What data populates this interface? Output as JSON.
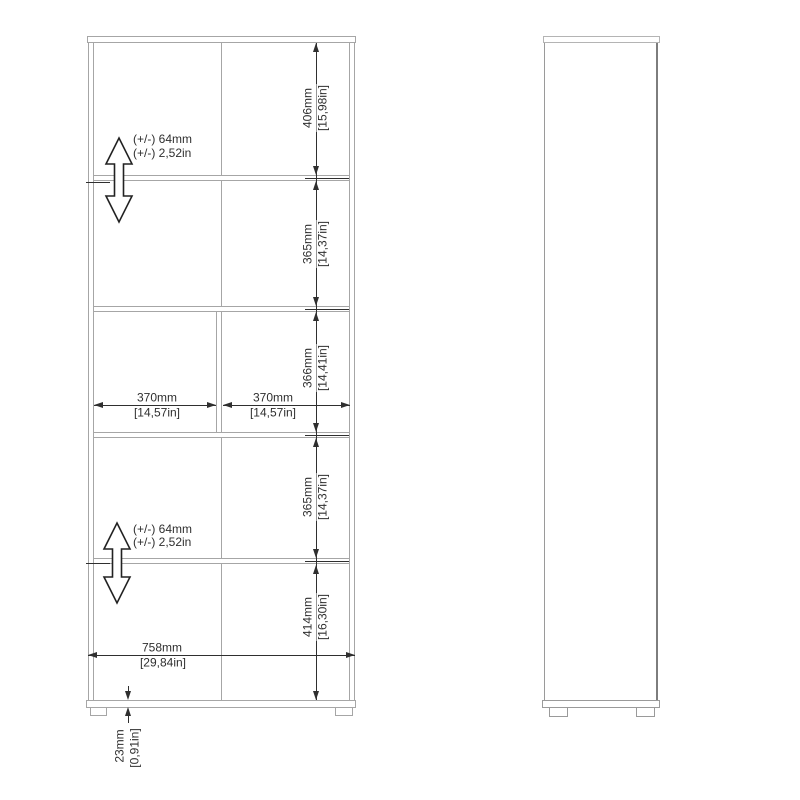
{
  "page": {
    "title": "Bookcase dimension drawing"
  },
  "colors": {
    "outline_gray": "#a6a6a6",
    "side_edge_gray": "#8d8d8d",
    "dimension_dark": "#2f2f2f",
    "background": "#ffffff"
  },
  "front_view": {
    "vertical_dims": [
      {
        "mm": "406mm",
        "in": "[15,98in]"
      },
      {
        "mm": "365mm",
        "in": "[14,37in]"
      },
      {
        "mm": "366mm",
        "in": "[14,41in]"
      },
      {
        "mm": "365mm",
        "in": "[14,37in]"
      },
      {
        "mm": "414mm",
        "in": "[16,30in]"
      }
    ],
    "horizontal_dims": {
      "left_compartment": {
        "mm": "370mm",
        "in": "[14,57in]"
      },
      "right_compartment": {
        "mm": "370mm",
        "in": "[14,57in]"
      },
      "overall_width": {
        "mm": "758mm",
        "in": "[29,84in]"
      }
    },
    "plinth_dim": {
      "mm": "23mm",
      "in": "[0,91in]"
    },
    "adjustable_shelf_notes": [
      {
        "line1": "(+/-) 64mm",
        "line2": "(+/-) 2,52in"
      },
      {
        "line1": "(+/-) 64mm",
        "line2": "(+/-) 2,52in"
      }
    ]
  }
}
